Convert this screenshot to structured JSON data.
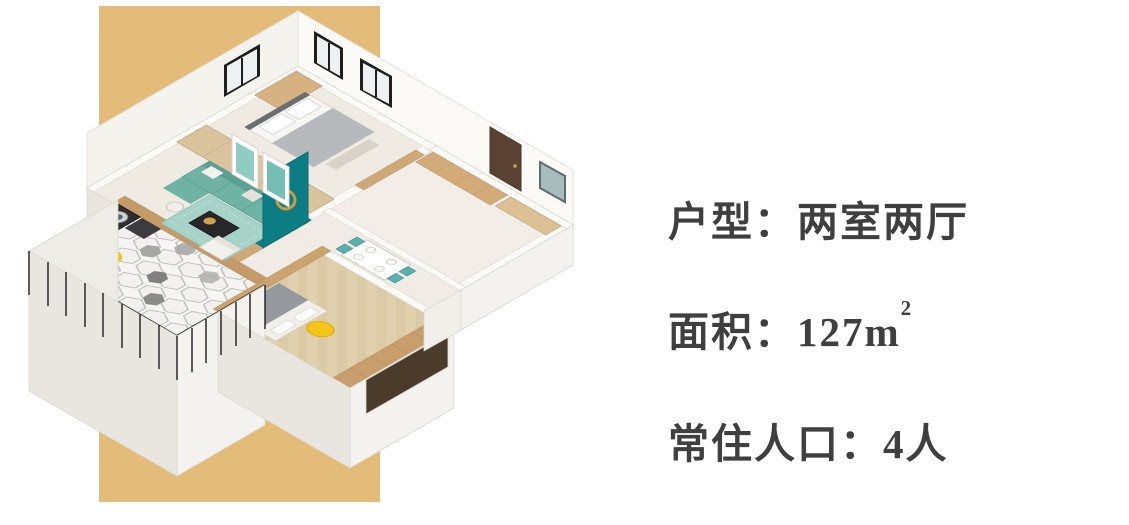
{
  "page": {
    "background": "#ffffff"
  },
  "accent": {
    "color": "#e4bc79"
  },
  "floorplan": {
    "palette": {
      "wall_white": "#fbfaf7",
      "floor_light": "#efeae2",
      "wood": "#cfa878",
      "wood_dark": "#c89e6c",
      "sofa_teal": "#6fb3a4",
      "rug_teal": "#a6d2c8",
      "accent_panel_teal": "#0d7d84",
      "accent_yellow": "#f5c518",
      "door_brown": "#5a4233",
      "railing_black": "#1d1d1d",
      "tile_light": "#f2f1ef"
    }
  },
  "info": {
    "text_color": "#3f3f3f",
    "lines": [
      {
        "id": "layout",
        "text": "户型：两室两厅"
      },
      {
        "id": "area",
        "text": "面积：127m",
        "superscript": "2"
      },
      {
        "id": "residents",
        "text": "常住人口：4人"
      }
    ]
  }
}
